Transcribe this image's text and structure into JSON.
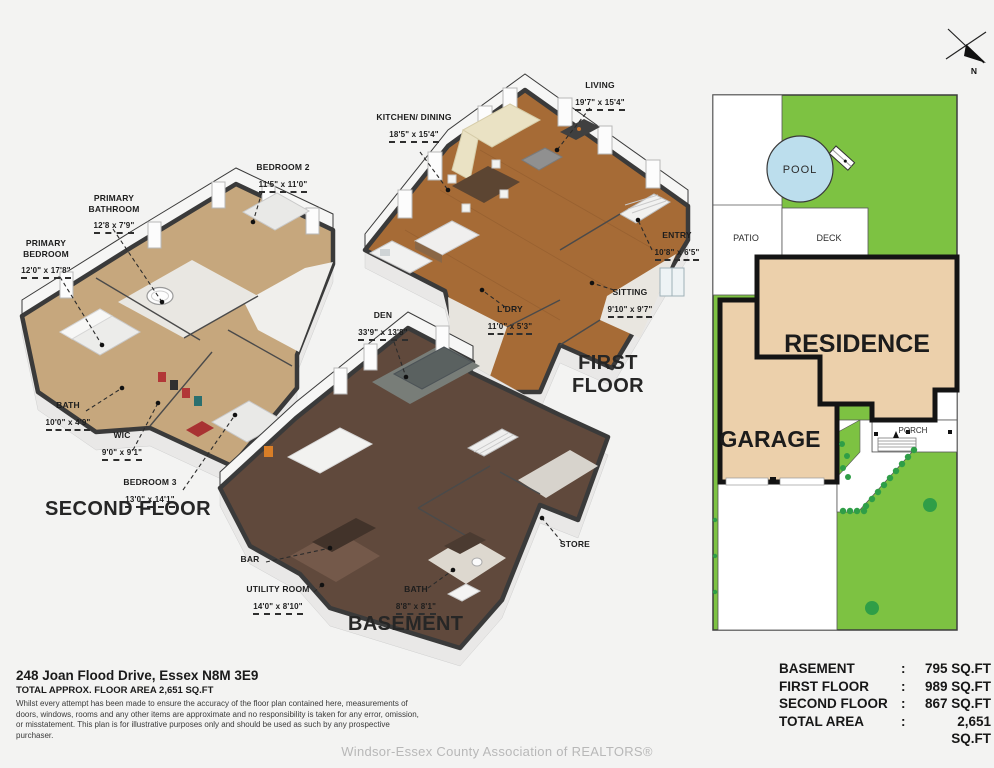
{
  "page": {
    "background": "#f3f3f2"
  },
  "compass": {
    "north_label": "N"
  },
  "floors": {
    "second": {
      "title": "SECOND FLOOR",
      "rooms": {
        "primary_bedroom": {
          "name": "PRIMARY BEDROOM",
          "dims": "12'0\" x 17'8\""
        },
        "primary_bathroom": {
          "name": "PRIMARY BATHROOM",
          "dims": "12'8 x 7'9\""
        },
        "bedroom_2": {
          "name": "BEDROOM 2",
          "dims": "11'5\" x 11'0\""
        },
        "bath": {
          "name": "BATH",
          "dims": "10'0\" x 4'9\""
        },
        "wic": {
          "name": "WIC",
          "dims": "9'0\" x 9'1\""
        },
        "bedroom_3": {
          "name": "BEDROOM 3",
          "dims": "13'0\" x 14'1\""
        }
      }
    },
    "first": {
      "title": "FIRST FLOOR",
      "rooms": {
        "kitchen_dining": {
          "name": "KITCHEN/ DINING",
          "dims": "18'5\" x 15'4\""
        },
        "living": {
          "name": "LIVING",
          "dims": "19'7\" x 15'4\""
        },
        "entry": {
          "name": "ENTRY",
          "dims": "10'8\" x 6'5\""
        },
        "laundry": {
          "name": "L'DRY",
          "dims": "11'0\" x 5'3\""
        },
        "sitting": {
          "name": "SITTING",
          "dims": "9'10\" x 9'7\""
        }
      }
    },
    "basement": {
      "title": "BASEMENT",
      "rooms": {
        "den": {
          "name": "DEN",
          "dims": "33'9\" x 13'8\""
        },
        "bar": {
          "name": "BAR"
        },
        "utility": {
          "name": "UTILITY ROOM",
          "dims": "14'0\" x 8'10\""
        },
        "bath": {
          "name": "BATH",
          "dims": "8'8\" x 8'1\""
        },
        "store": {
          "name": "STORE"
        }
      }
    }
  },
  "site_plan": {
    "labels": {
      "pool": "POOL",
      "patio": "PATIO",
      "deck": "DECK",
      "residence": "RESIDENCE",
      "garage": "GARAGE",
      "porch": "PORCH"
    },
    "colors": {
      "lawn": "#7dc242",
      "hedge": "#2f9e47",
      "pool": "#bcdeed",
      "building": "#ecd0ab"
    }
  },
  "footer": {
    "address": "248 Joan Flood Drive, Essex N8M 3E9",
    "total_area_line": "TOTAL APPROX. FLOOR AREA 2,651 SQ.FT",
    "disclaimer": "Whilst every attempt has been made to ensure the accuracy of the floor plan contained here, measurements of doors, windows, rooms and any other items are approximate and no responsibility is taken for any error, omission, or misstatement. This plan is for illustrative purposes only and should be used as such by any prospective purchaser.",
    "watermark": "Windsor-Essex County Association of REALTORS®"
  },
  "area_table": {
    "rows": [
      {
        "label": "BASEMENT",
        "colon": ":",
        "value": "795 SQ.FT"
      },
      {
        "label": "FIRST FLOOR",
        "colon": ":",
        "value": "989 SQ.FT"
      },
      {
        "label": "SECOND FLOOR",
        "colon": ":",
        "value": "867 SQ.FT"
      },
      {
        "label": "TOTAL AREA",
        "colon": ":",
        "value": "2,651 SQ.FT"
      }
    ]
  }
}
